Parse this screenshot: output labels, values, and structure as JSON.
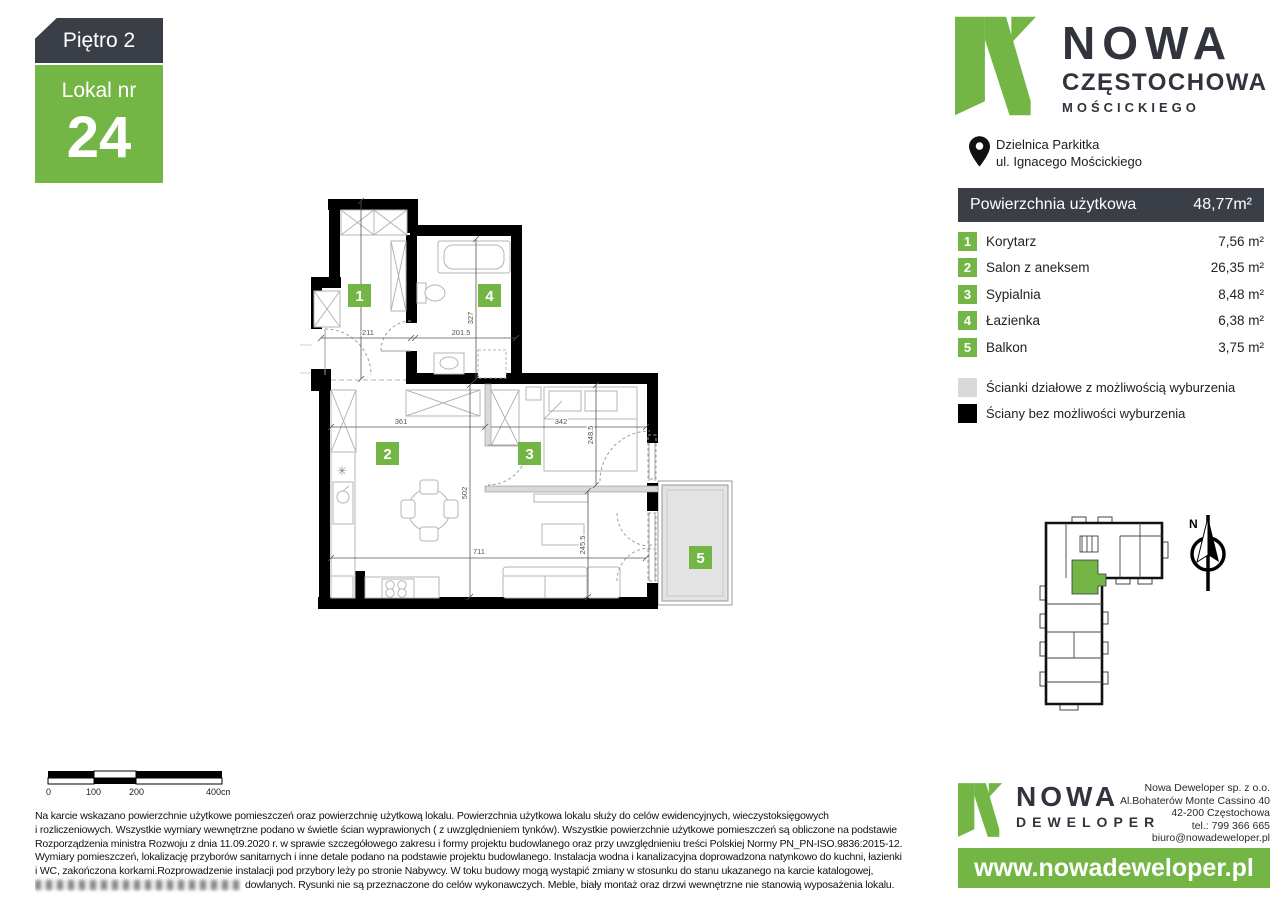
{
  "badge": {
    "floor": "Piętro 2",
    "unit_label": "Lokal nr",
    "unit_number": "24"
  },
  "brand": {
    "line1": "NOWA",
    "line2": "CZĘSTOCHOWA",
    "line3": "MOŚCICKIEGO",
    "location1": "Dzielnica Parkitka",
    "location2": "ul. Ignacego Mościckiego"
  },
  "area_table": {
    "header_label": "Powierzchnia użytkowa",
    "header_value": "48,77m²",
    "rows": [
      {
        "no": "1",
        "label": "Korytarz",
        "area": "7,56 m²"
      },
      {
        "no": "2",
        "label": "Salon z aneksem",
        "area": "26,35 m²"
      },
      {
        "no": "3",
        "label": "Sypialnia",
        "area": "8,48 m²"
      },
      {
        "no": "4",
        "label": "Łazienka",
        "area": "6,38 m²"
      },
      {
        "no": "5",
        "label": "Balkon",
        "area": "3,75 m²"
      }
    ]
  },
  "legend": {
    "partition": "Ścianki działowe z możliwością wyburzenia",
    "solid": "Ściany bez możliwości wyburzenia"
  },
  "plan": {
    "rooms": [
      "1",
      "2",
      "3",
      "4",
      "5"
    ],
    "dims": {
      "d409": "409",
      "d211": "211",
      "d2015": "201.5",
      "d327": "327",
      "d361": "361",
      "d342": "342",
      "d2485": "248.5",
      "d502": "502",
      "d711": "711",
      "d2455": "245.5"
    }
  },
  "scalebar": {
    "t0": "0",
    "t100": "100",
    "t200": "200",
    "t400": "400cm"
  },
  "compass": {
    "n": "N"
  },
  "disclaimer": {
    "line1": "Na karcie wskazano powierzchnie użytkowe pomieszczeń oraz powierzchnię użytkową lokalu. Powierzchnia użytkowa lokalu służy do celów ewidencyjnych, wieczystoksięgowych",
    "line2": "i rozliczeniowych. Wszystkie wymiary wewnętrzne podano w świetle ścian wyprawionych ( z uwzględnieniem tynków). Wszystkie powierzchnie użytkowe pomieszczeń są obliczone na podstawie",
    "line3": "Rozporządzenia ministra Rozwoju z dnia 11.09.2020 r. w sprawie szczegółowego zakresu i formy projektu budowlanego oraz przy uwzględnieniu treści Polskiej Normy PN_PN-ISO.9836:2015-12.",
    "line4": "Wymiary pomieszczeń, lokalizację przyborów sanitarnych i inne detale podano na podstawie projektu budowlanego. Instalacja wodna i kanalizacyjna doprowadzona natynkowo do kuchni, łazienki",
    "line5": "i WC, zakończona korkami.Rozprowadzenie instalacji pod przybory leży po stronie Nabywcy. W toku budowy mogą wystąpić zmiany w stosunku do stanu ukazanego na karcie katalogowej,",
    "line6": "dowlanych. Rysunki nie są przeznaczone do celów wykonawczych. Meble, biały montaż oraz drzwi wewnętrzne nie stanowią wyposażenia lokalu."
  },
  "company": {
    "name1": "NOWA",
    "name2": "DEWELOPER",
    "info1": "Nowa Deweloper sp. z o.o.",
    "info2": "Al.Bohaterów Monte Cassino 40",
    "info3": "42-200 Częstochowa",
    "info4": "tel.: 799 366 665",
    "info5": "biuro@nowadeweloper.pl",
    "website": "www.nowadeweloper.pl"
  },
  "colors": {
    "green": "#74b645",
    "dark": "#3a3e47",
    "partition": "#d9d9d9",
    "balcony": "#e3e3e3"
  }
}
